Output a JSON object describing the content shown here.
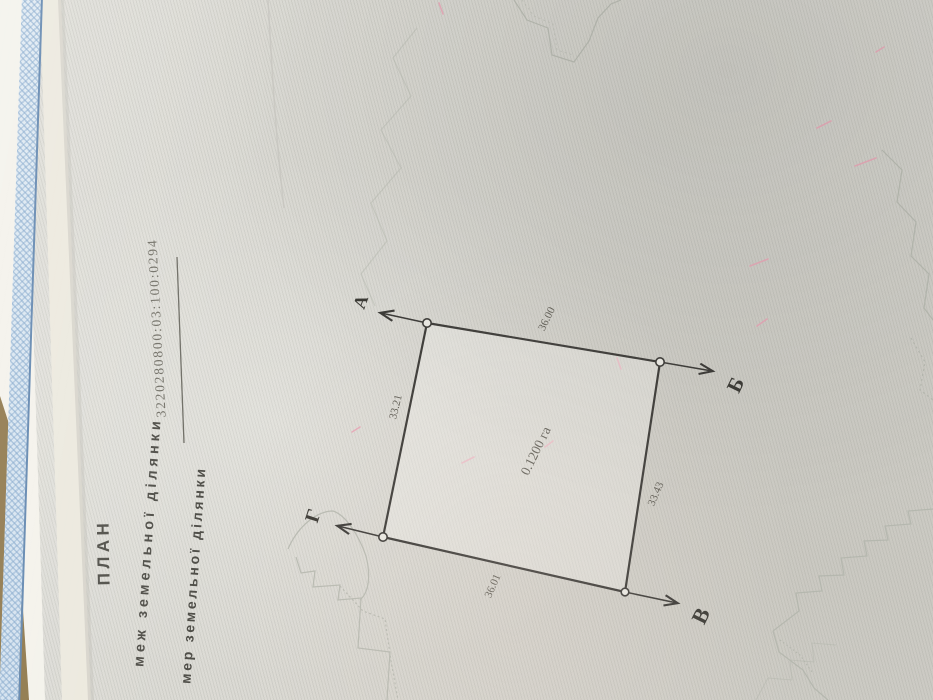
{
  "page": {
    "header": {
      "title": "ПЛАН",
      "subtitle": "меж земельної ділянки",
      "cadastral_number": "3220280800:03:100:0294",
      "cadastral_label": "мер земельної ділянки"
    },
    "plan": {
      "area": "0.1200 га",
      "vertices": [
        {
          "name": "А"
        },
        {
          "name": "Б"
        },
        {
          "name": "В"
        },
        {
          "name": "Г"
        }
      ],
      "sides": [
        {
          "from": "А",
          "to": "Б",
          "length": "36.00"
        },
        {
          "from": "Б",
          "to": "В",
          "length": "33.43"
        },
        {
          "from": "В",
          "to": "Г",
          "length": "36.01"
        },
        {
          "from": "Г",
          "to": "А",
          "length": "33.21"
        }
      ]
    },
    "colors": {
      "paper": "#dcdbd5",
      "ink": "#3a3936",
      "faded_ink": "#716f66",
      "border_blue": "#5d83ad",
      "border_blue_light": "#c7dbec",
      "table_brown": "#8c7446",
      "decor_line": "#b2b5ac",
      "pink_mark": "#e7a3b4"
    }
  }
}
